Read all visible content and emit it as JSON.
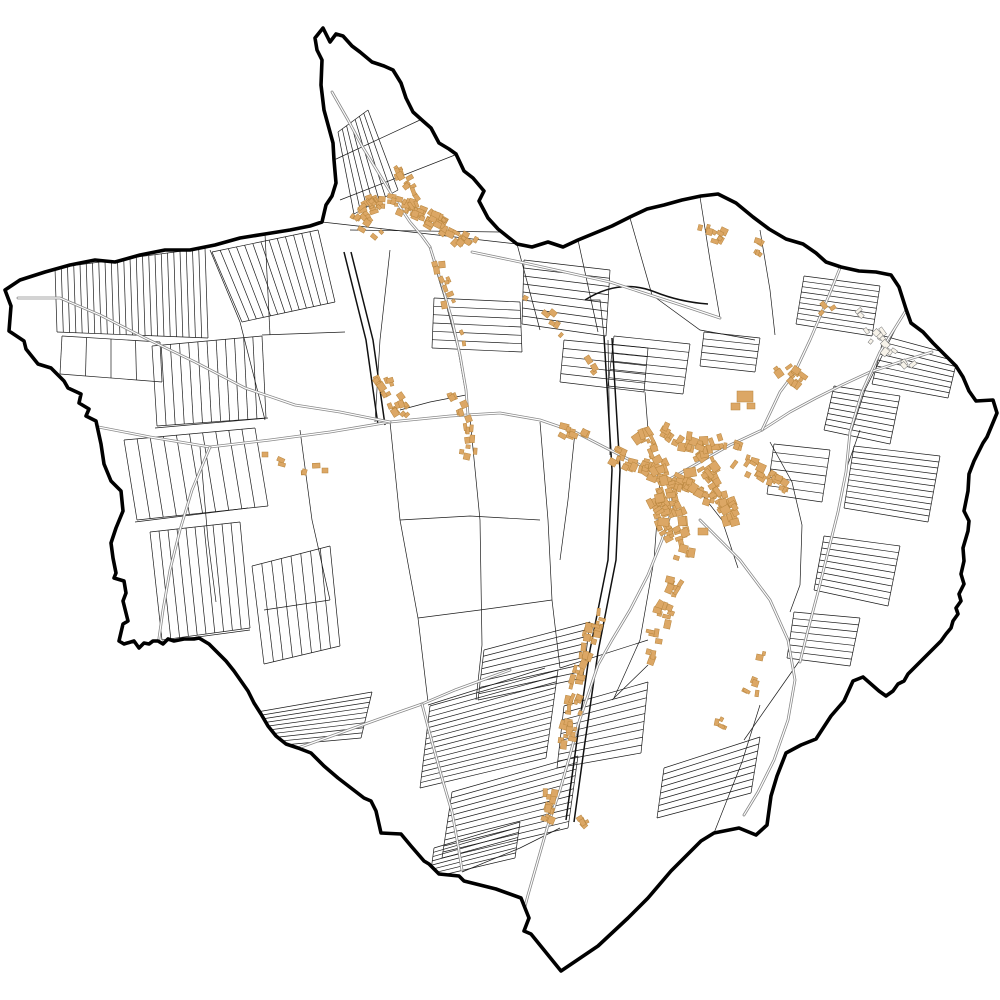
{
  "canvas": {
    "width": 1000,
    "height": 1000,
    "background": "#ffffff"
  },
  "colors": {
    "boundary": "#000000",
    "parcel_line": "#1c1c1c",
    "major_line": "#111111",
    "road_casing": "#8a8a8a",
    "road_fill": "#ffffff",
    "building_fill": "#DCA765",
    "building_stroke": "#B8863F",
    "pale_building_fill": "#f7f3ea",
    "pale_building_stroke": "#777777",
    "map_fill": "#ffffff"
  },
  "stroke_widths": {
    "boundary": 3.6,
    "parcel": 0.7,
    "major": 1.5,
    "road_casing": 2.8,
    "road_fill": 1.2,
    "building": 0.5
  },
  "boundary_path": "M5,290 L20,280 45,272 70,265 95,260 115,262 140,255 165,250 190,250 215,245 240,238 265,234 290,230 310,226 322,222 326,205 332,196 336,183 334,160 333,143 324,110 321,85 322,60 317,50 315,38 323,28 330,42 336,34 343,36 352,46 360,52 372,62 384,66 393,70 401,83 406,98 413,112 423,121 431,128 439,143 449,149 456,154 464,171 473,178 484,191 479,201 488,218 498,229 508,237 517,244 532,247 548,242 563,247 578,240 595,233 612,226 630,217 647,209 664,205 682,200 701,196 718,194 736,203 753,217 769,229 786,239 803,244 816,253 826,262 841,267 859,271 876,272 891,275 899,287 906,309 911,323 923,332 933,343 946,356 956,366 963,377 969,391 976,401 993,400 997,413 987,437 983,443 974,461 969,474 968,491 964,511 969,521 968,531 963,548 964,561 961,574 964,584 959,594 961,601 956,608 958,614 953,621 951,628 946,634 941,641 934,648 928,654 921,661 914,668 908,674 904,681 898,684 893,691 886,696 879,691 871,684 863,677 853,681 844,701 831,716 816,739 801,745 786,753 777,776 771,796 767,825 756,835 739,828 714,833 701,841 671,871 648,898 628,918 598,946 561,971 531,934 524,931 529,918 521,898 496,889 464,881 459,876 439,874 429,864 424,861 411,846 401,834 381,833 376,811 371,801 364,798 351,788 338,778 324,766 311,753 298,748 286,744 276,736 268,726 261,714 254,703 248,691 241,681 234,671 226,661 219,654 209,644 204,641 199,638 194,639 184,639 174,641 168,639 163,644 158,641 153,641 149,644 144,643 139,648 134,641 124,644 119,641 123,624 128,621 123,601 126,593 124,581 114,578 116,573 113,558 111,543 116,528 123,511 121,491 111,481 104,464 101,444 96,421 86,416 89,409 79,403 81,394 68,388 64,381 51,368 38,364 26,349 24,341 9,331 11,306 Z",
  "strip_groups": [
    [
      55,
      268,
      205,
      248,
      57,
      332,
      208,
      338,
      24
    ],
    [
      62,
      336,
      160,
      342,
      60,
      374,
      162,
      382,
      4
    ],
    [
      212,
      252,
      318,
      230,
      242,
      322,
      335,
      302,
      13
    ],
    [
      152,
      346,
      262,
      336,
      157,
      426,
      266,
      418,
      12
    ],
    [
      124,
      440,
      255,
      428,
      137,
      520,
      268,
      506,
      10
    ],
    [
      150,
      532,
      240,
      522,
      162,
      640,
      250,
      628,
      10
    ],
    [
      252,
      566,
      330,
      546,
      264,
      664,
      340,
      646,
      8
    ],
    [
      338,
      132,
      368,
      110,
      354,
      214,
      398,
      190,
      7
    ],
    [
      524,
      260,
      522,
      324,
      610,
      270,
      606,
      336,
      8
    ],
    [
      434,
      298,
      432,
      348,
      520,
      302,
      522,
      352,
      6
    ],
    [
      564,
      340,
      560,
      382,
      648,
      348,
      644,
      392,
      5
    ],
    [
      430,
      706,
      420,
      788,
      558,
      670,
      546,
      758,
      15
    ],
    [
      452,
      792,
      442,
      858,
      578,
      756,
      568,
      828,
      11
    ],
    [
      257,
      712,
      250,
      748,
      372,
      692,
      361,
      738,
      9
    ],
    [
      434,
      848,
      430,
      878,
      520,
      822,
      515,
      858,
      7
    ],
    [
      484,
      650,
      478,
      700,
      590,
      622,
      583,
      678,
      8
    ],
    [
      564,
      706,
      557,
      768,
      648,
      682,
      641,
      753,
      9
    ],
    [
      664,
      768,
      657,
      818,
      760,
      737,
      751,
      793,
      8
    ],
    [
      804,
      276,
      796,
      324,
      880,
      286,
      872,
      336,
      9
    ],
    [
      884,
      336,
      872,
      384,
      958,
      356,
      948,
      398,
      8
    ],
    [
      834,
      386,
      824,
      430,
      900,
      396,
      890,
      444,
      8
    ],
    [
      854,
      446,
      844,
      508,
      940,
      456,
      928,
      522,
      11
    ],
    [
      824,
      536,
      814,
      590,
      900,
      546,
      888,
      606,
      9
    ],
    [
      794,
      612,
      787,
      658,
      860,
      618,
      850,
      666,
      7
    ],
    [
      704,
      332,
      700,
      366,
      760,
      338,
      755,
      372,
      5
    ],
    [
      774,
      444,
      767,
      494,
      830,
      450,
      822,
      502,
      6
    ],
    [
      614,
      336,
      608,
      386,
      690,
      344,
      683,
      394,
      6
    ]
  ],
  "parcel_paths": [
    "M322,222 L517,244",
    "M334,160 L420,120",
    "M340,200 L455,155",
    "M350,230 L500,232",
    "M265,234 L270,335",
    "M262,335 L345,332",
    "M210,250 L240,322",
    "M240,322 L265,420",
    "M155,428 L268,418",
    "M135,522 L248,508",
    "M160,642 L250,630",
    "M390,250 L380,340 L375,422",
    "M430,250 L445,300 L458,350 L466,395",
    "M390,422 L400,520 L418,618 L428,702",
    "M470,418 L480,520 L482,645",
    "M540,422 L548,520 L552,600 L560,668",
    "M604,336 L600,300 L585,300",
    "M517,244 L540,330",
    "M578,240 L598,332",
    "M630,218 L652,295",
    "M700,197 L710,260 L720,318",
    "M760,230 L770,290 L775,335",
    "M652,295 L700,330 L755,340",
    "M610,455 L608,340",
    "M660,480 L654,560 L640,640 L614,698",
    "M700,492 L722,520 L738,568",
    "M770,442 L792,482 L802,525 L800,585",
    "M800,585 L790,612",
    "M714,833 L742,762 L760,705",
    "M800,660 L772,700 L744,740",
    "M462,872 L520,848 L560,828",
    "M300,430 L312,520 L330,600",
    "M200,447 L208,540 L216,602",
    "M428,705 L545,668",
    "M560,668 L648,640",
    "M575,432 L568,500 L560,560",
    "M645,392 L648,430",
    "M482,645 L476,700",
    "M860,430 L846,470 L838,512",
    "M905,310 L885,350 L865,390 L852,430",
    "M648,665 L612,700",
    "M400,520 L470,516 L540,520",
    "M418,618 L480,610 L552,600",
    "M330,600 L264,610",
    "M466,395 L430,402 L400,410"
  ],
  "major_lines": [
    "M344,252 L366,340 L378,425",
    "M351,252 L373,340 L385,425",
    "M604,336 L612,470 L608,560 L590,650 L577,740 L566,820",
    "M612,338 L620,470 L616,560 L598,652 L585,742 L574,822",
    "M585,300 Q620,278 655,292 Q680,302 708,304"
  ],
  "roads": [
    [
      [
        88,
        425
      ],
      [
        150,
        437
      ],
      [
        210,
        447
      ],
      [
        270,
        440
      ],
      [
        330,
        432
      ],
      [
        390,
        422
      ],
      [
        450,
        416
      ],
      [
        500,
        413
      ],
      [
        540,
        420
      ],
      [
        575,
        432
      ],
      [
        610,
        450
      ],
      [
        640,
        465
      ],
      [
        668,
        480
      ]
    ],
    [
      [
        668,
        480
      ],
      [
        700,
        462
      ],
      [
        730,
        445
      ],
      [
        762,
        430
      ],
      [
        790,
        412
      ],
      [
        816,
        398
      ],
      [
        842,
        385
      ],
      [
        870,
        372
      ],
      [
        900,
        362
      ],
      [
        932,
        352
      ]
    ],
    [
      [
        762,
        430
      ],
      [
        780,
        392
      ],
      [
        795,
        372
      ],
      [
        810,
        340
      ],
      [
        822,
        312
      ],
      [
        832,
        288
      ],
      [
        840,
        268
      ]
    ],
    [
      [
        668,
        480
      ],
      [
        672,
        510
      ],
      [
        662,
        540
      ],
      [
        648,
        575
      ],
      [
        630,
        610
      ],
      [
        612,
        640
      ],
      [
        598,
        665
      ],
      [
        588,
        695
      ],
      [
        578,
        725
      ],
      [
        570,
        755
      ],
      [
        560,
        790
      ],
      [
        548,
        825
      ],
      [
        538,
        860
      ],
      [
        528,
        895
      ],
      [
        522,
        918
      ]
    ],
    [
      [
        430,
        247
      ],
      [
        442,
        285
      ],
      [
        452,
        320
      ],
      [
        460,
        355
      ],
      [
        466,
        390
      ],
      [
        468,
        415
      ]
    ],
    [
      [
        332,
        92
      ],
      [
        348,
        120
      ],
      [
        362,
        146
      ],
      [
        378,
        172
      ],
      [
        394,
        198
      ],
      [
        410,
        222
      ],
      [
        422,
        236
      ],
      [
        430,
        247
      ]
    ],
    [
      [
        472,
        252
      ],
      [
        520,
        262
      ],
      [
        565,
        272
      ],
      [
        610,
        282
      ],
      [
        650,
        295
      ],
      [
        690,
        308
      ],
      [
        720,
        318
      ]
    ],
    [
      [
        18,
        298
      ],
      [
        60,
        298
      ],
      [
        100,
        315
      ],
      [
        145,
        338
      ],
      [
        195,
        362
      ],
      [
        245,
        388
      ],
      [
        295,
        405
      ],
      [
        340,
        412
      ],
      [
        390,
        422
      ]
    ],
    [
      [
        298,
        748
      ],
      [
        340,
        733
      ],
      [
        382,
        718
      ],
      [
        422,
        704
      ],
      [
        455,
        690
      ],
      [
        488,
        678
      ],
      [
        510,
        670
      ]
    ],
    [
      [
        422,
        704
      ],
      [
        432,
        742
      ],
      [
        442,
        778
      ],
      [
        452,
        812
      ],
      [
        458,
        845
      ],
      [
        462,
        870
      ]
    ],
    [
      [
        700,
        520
      ],
      [
        740,
        560
      ],
      [
        770,
        600
      ],
      [
        788,
        640
      ],
      [
        795,
        680
      ],
      [
        788,
        720
      ],
      [
        774,
        760
      ],
      [
        758,
        792
      ],
      [
        744,
        815
      ]
    ],
    [
      [
        905,
        312
      ],
      [
        880,
        352
      ],
      [
        862,
        392
      ],
      [
        850,
        432
      ],
      [
        846,
        472
      ],
      [
        838,
        512
      ],
      [
        828,
        552
      ],
      [
        818,
        592
      ],
      [
        808,
        630
      ],
      [
        800,
        662
      ]
    ],
    [
      [
        210,
        447
      ],
      [
        192,
        490
      ],
      [
        180,
        530
      ],
      [
        170,
        570
      ],
      [
        163,
        610
      ],
      [
        158,
        645
      ]
    ]
  ],
  "building_clusters": [
    {
      "pts": [
        [
          362,
          212
        ],
        [
          380,
          202
        ],
        [
          400,
          206
        ],
        [
          420,
          214
        ],
        [
          438,
          224
        ],
        [
          456,
          236
        ],
        [
          472,
          246
        ]
      ],
      "n": 75,
      "s": 6,
      "seed": 11
    },
    {
      "pts": [
        [
          398,
          168
        ],
        [
          404,
          182
        ],
        [
          412,
          196
        ],
        [
          420,
          208
        ]
      ],
      "n": 16,
      "s": 5,
      "seed": 12
    },
    {
      "pts": [
        [
          434,
          258
        ],
        [
          444,
          292
        ],
        [
          452,
          322
        ],
        [
          460,
          352
        ]
      ],
      "n": 12,
      "s": 5,
      "seed": 13
    },
    {
      "pts": [
        [
          352,
          214
        ],
        [
          366,
          224
        ],
        [
          380,
          236
        ]
      ],
      "n": 10,
      "s": 5,
      "seed": 14
    },
    {
      "pts": [
        [
          382,
          375
        ],
        [
          390,
          390
        ],
        [
          398,
          406
        ],
        [
          406,
          418
        ]
      ],
      "n": 22,
      "s": 6,
      "seed": 15
    },
    {
      "pts": [
        [
          268,
          452
        ],
        [
          300,
          468
        ],
        [
          330,
          473
        ]
      ],
      "n": 5,
      "s": 5,
      "seed": 16
    },
    {
      "pts": [
        [
          455,
          392
        ],
        [
          462,
          410
        ],
        [
          467,
          428
        ],
        [
          469,
          446
        ],
        [
          467,
          462
        ]
      ],
      "n": 18,
      "s": 5,
      "seed": 17
    },
    {
      "pts": [
        [
          612,
          455
        ],
        [
          640,
          466
        ],
        [
          668,
          478
        ],
        [
          694,
          490
        ],
        [
          718,
          500
        ]
      ],
      "n": 55,
      "s": 8,
      "seed": 21
    },
    {
      "pts": [
        [
          642,
          432
        ],
        [
          656,
          462
        ],
        [
          668,
          492
        ],
        [
          678,
          520
        ],
        [
          686,
          546
        ]
      ],
      "n": 50,
      "s": 8,
      "seed": 22
    },
    {
      "pts": [
        [
          700,
          452
        ],
        [
          714,
          476
        ],
        [
          724,
          500
        ],
        [
          734,
          524
        ]
      ],
      "n": 40,
      "s": 8,
      "seed": 23
    },
    {
      "pts": [
        [
          662,
          430
        ],
        [
          682,
          440
        ],
        [
          702,
          446
        ],
        [
          722,
          442
        ],
        [
          744,
          446
        ]
      ],
      "n": 30,
      "s": 7,
      "seed": 24
    },
    {
      "pts": [
        [
          686,
          548
        ],
        [
          677,
          580
        ],
        [
          665,
          610
        ],
        [
          656,
          638
        ],
        [
          648,
          662
        ]
      ],
      "n": 26,
      "s": 7,
      "seed": 25
    },
    {
      "pts": [
        [
          736,
          460
        ],
        [
          756,
          470
        ],
        [
          774,
          478
        ],
        [
          790,
          486
        ]
      ],
      "n": 20,
      "s": 7,
      "seed": 26
    },
    {
      "pts": [
        [
          654,
          500
        ],
        [
          663,
          520
        ],
        [
          671,
          540
        ]
      ],
      "n": 24,
      "s": 8,
      "seed": 27
    },
    {
      "pts": [
        [
          600,
          600
        ],
        [
          592,
          630
        ],
        [
          584,
          660
        ],
        [
          577,
          690
        ],
        [
          571,
          718
        ],
        [
          566,
          746
        ]
      ],
      "n": 45,
      "s": 7,
      "seed": 31
    },
    {
      "pts": [
        [
          552,
          780
        ],
        [
          548,
          804
        ],
        [
          543,
          826
        ]
      ],
      "n": 12,
      "s": 6,
      "seed": 32
    },
    {
      "pts": [
        [
          582,
          812
        ],
        [
          590,
          824
        ]
      ],
      "n": 5,
      "s": 5,
      "seed": 33
    },
    {
      "pts": [
        [
          700,
          228
        ],
        [
          714,
          234
        ],
        [
          728,
          242
        ]
      ],
      "n": 9,
      "s": 6,
      "seed": 41
    },
    {
      "pts": [
        [
          755,
          245
        ],
        [
          766,
          251
        ]
      ],
      "n": 5,
      "s": 5,
      "seed": 42
    },
    {
      "pts": [
        [
          780,
          364
        ],
        [
          790,
          374
        ],
        [
          800,
          382
        ]
      ],
      "n": 12,
      "s": 6,
      "seed": 43
    },
    {
      "pts": [
        [
          520,
          295
        ],
        [
          545,
          315
        ],
        [
          568,
          334
        ]
      ],
      "n": 6,
      "s": 5,
      "seed": 44
    },
    {
      "pts": [
        [
          588,
          358
        ],
        [
          598,
          370
        ]
      ],
      "n": 3,
      "s": 5,
      "seed": 45
    },
    {
      "pts": [
        [
          560,
          428
        ],
        [
          572,
          432
        ],
        [
          584,
          438
        ]
      ],
      "n": 8,
      "s": 6,
      "seed": 46
    },
    {
      "pts": [
        [
          762,
          652
        ],
        [
          754,
          678
        ],
        [
          747,
          700
        ]
      ],
      "n": 7,
      "s": 6,
      "seed": 47
    },
    {
      "pts": [
        [
          724,
          716
        ],
        [
          717,
          734
        ]
      ],
      "n": 4,
      "s": 5,
      "seed": 48
    },
    {
      "pts": [
        [
          820,
          304
        ],
        [
          828,
          314
        ]
      ],
      "n": 3,
      "s": 5,
      "seed": 49
    }
  ],
  "building_rects": [
    [
      737,
      391,
      16,
      11,
      0
    ],
    [
      731,
      403,
      9,
      7,
      0
    ],
    [
      747,
      403,
      8,
      6,
      0
    ],
    [
      684,
      468,
      12,
      9,
      -10
    ],
    [
      658,
      518,
      11,
      8,
      5
    ],
    [
      698,
      528,
      10,
      7,
      0
    ],
    [
      262,
      452,
      6,
      5,
      0
    ],
    [
      322,
      468,
      6,
      5,
      0
    ]
  ],
  "pale_buildings": {
    "pts": [
      [
        852,
        310
      ],
      [
        868,
        328
      ],
      [
        884,
        344
      ],
      [
        898,
        358
      ],
      [
        910,
        372
      ]
    ],
    "n": 16,
    "s": 6,
    "seed": 77
  }
}
